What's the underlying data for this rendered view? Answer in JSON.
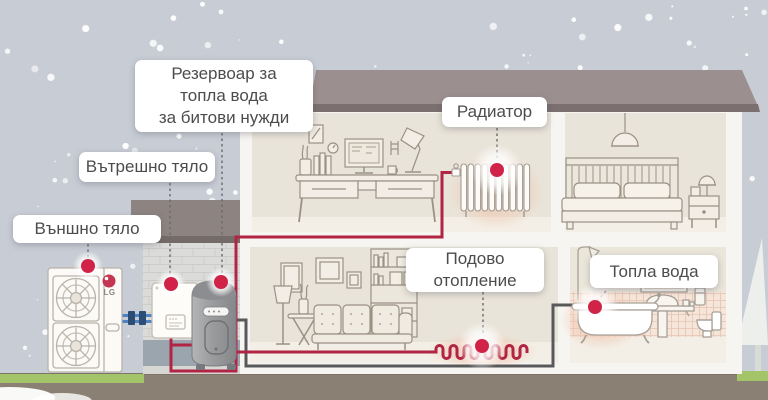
{
  "labels": {
    "reservoir": [
      "Резервоар за",
      "топла вода",
      "за битови нужди"
    ],
    "indoor_unit": "Вътрешно тяло",
    "outdoor_unit": "Външно тяло",
    "radiator": "Радиатор",
    "floor_heating": [
      "Подово",
      "отопление"
    ],
    "hot_water": "Топла вода"
  },
  "brand_logo": "LG",
  "colors": {
    "accent_red": "#b12444",
    "marker_red": "#d02347",
    "pipe_gray": "#58595b",
    "pipe_blue": "#4e82c4",
    "sky": "#c8cdd5",
    "roof": "#9c8f8f",
    "ground": "#8b8074",
    "grass": "#a3c468"
  }
}
